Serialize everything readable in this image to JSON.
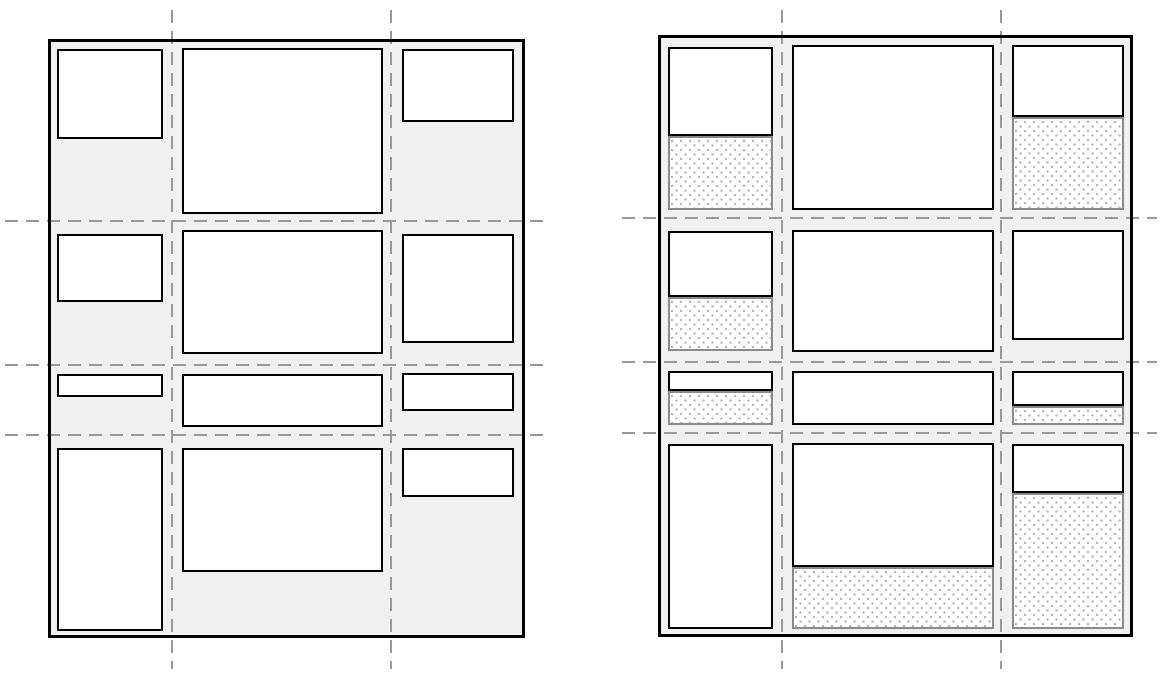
{
  "colors": {
    "page_background": "#ffffff",
    "container_fill": "#f0f0f0",
    "container_border": "#000000",
    "item_fill": "#ffffff",
    "item_border": "#000000",
    "gridline": "#999999",
    "placeholder_border": "#8a8a8a",
    "placeholder_fill": "#ffffff",
    "placeholder_dot": "#b4b4b4"
  },
  "gridline_style": {
    "dash_length": 13,
    "gap_length": 8,
    "thickness": 2.6
  },
  "panels": [
    {
      "name": "left-grid",
      "container": {
        "x": 48,
        "y": 39,
        "w": 477,
        "h": 599
      },
      "v_gridlines": [
        {
          "x": 172,
          "y1": 10,
          "y2": 669
        },
        {
          "x": 391,
          "y1": 10,
          "y2": 669
        }
      ],
      "h_gridlines": [
        {
          "y": 221,
          "x1": 5,
          "x2": 545
        },
        {
          "y": 365,
          "x1": 5,
          "x2": 545
        },
        {
          "y": 435,
          "x1": 5,
          "x2": 545
        }
      ],
      "items": [
        {
          "row": 1,
          "col": 1,
          "x": 57,
          "y": 49,
          "w": 106,
          "h": 90
        },
        {
          "row": 1,
          "col": 2,
          "x": 182,
          "y": 48,
          "w": 201,
          "h": 166
        },
        {
          "row": 1,
          "col": 3,
          "x": 402,
          "y": 49,
          "w": 112,
          "h": 73
        },
        {
          "row": 2,
          "col": 1,
          "x": 57,
          "y": 234,
          "w": 106,
          "h": 68
        },
        {
          "row": 2,
          "col": 2,
          "x": 182,
          "y": 230,
          "w": 201,
          "h": 124
        },
        {
          "row": 2,
          "col": 3,
          "x": 402,
          "y": 234,
          "w": 112,
          "h": 109
        },
        {
          "row": 3,
          "col": 1,
          "x": 57,
          "y": 374,
          "w": 106,
          "h": 23
        },
        {
          "row": 3,
          "col": 2,
          "x": 182,
          "y": 374,
          "w": 201,
          "h": 53
        },
        {
          "row": 3,
          "col": 3,
          "x": 402,
          "y": 373,
          "w": 112,
          "h": 38
        },
        {
          "row": 4,
          "col": 1,
          "x": 57,
          "y": 448,
          "w": 106,
          "h": 183
        },
        {
          "row": 4,
          "col": 2,
          "x": 182,
          "y": 448,
          "w": 201,
          "h": 124
        },
        {
          "row": 4,
          "col": 3,
          "x": 402,
          "y": 448,
          "w": 112,
          "h": 49
        }
      ],
      "placeholders": []
    },
    {
      "name": "right-grid",
      "container": {
        "x": 658,
        "y": 35,
        "w": 475,
        "h": 602
      },
      "v_gridlines": [
        {
          "x": 782,
          "y1": 10,
          "y2": 669
        },
        {
          "x": 1001,
          "y1": 10,
          "y2": 669
        }
      ],
      "h_gridlines": [
        {
          "y": 218,
          "x1": 622,
          "x2": 1157
        },
        {
          "y": 362,
          "x1": 622,
          "x2": 1157
        },
        {
          "y": 433,
          "x1": 622,
          "x2": 1157
        }
      ],
      "items": [
        {
          "row": 1,
          "col": 1,
          "x": 668,
          "y": 47,
          "w": 105,
          "h": 89
        },
        {
          "row": 1,
          "col": 2,
          "x": 792,
          "y": 45,
          "w": 202,
          "h": 165
        },
        {
          "row": 1,
          "col": 3,
          "x": 1012,
          "y": 45,
          "w": 112,
          "h": 72
        },
        {
          "row": 2,
          "col": 1,
          "x": 668,
          "y": 231,
          "w": 105,
          "h": 66
        },
        {
          "row": 2,
          "col": 2,
          "x": 792,
          "y": 230,
          "w": 202,
          "h": 122
        },
        {
          "row": 2,
          "col": 3,
          "x": 1012,
          "y": 230,
          "w": 112,
          "h": 110
        },
        {
          "row": 3,
          "col": 1,
          "x": 668,
          "y": 371,
          "w": 105,
          "h": 20
        },
        {
          "row": 3,
          "col": 2,
          "x": 792,
          "y": 371,
          "w": 202,
          "h": 54
        },
        {
          "row": 3,
          "col": 3,
          "x": 1012,
          "y": 371,
          "w": 112,
          "h": 35
        },
        {
          "row": 4,
          "col": 1,
          "x": 668,
          "y": 444,
          "w": 105,
          "h": 185
        },
        {
          "row": 4,
          "col": 2,
          "x": 792,
          "y": 443,
          "w": 202,
          "h": 124
        },
        {
          "row": 4,
          "col": 3,
          "x": 1012,
          "y": 444,
          "w": 112,
          "h": 49
        }
      ],
      "placeholders": [
        {
          "row": 1,
          "col": 1,
          "x": 668,
          "y": 136,
          "w": 105,
          "h": 74
        },
        {
          "row": 1,
          "col": 3,
          "x": 1012,
          "y": 117,
          "w": 112,
          "h": 93
        },
        {
          "row": 2,
          "col": 1,
          "x": 668,
          "y": 297,
          "w": 105,
          "h": 54
        },
        {
          "row": 3,
          "col": 1,
          "x": 668,
          "y": 391,
          "w": 105,
          "h": 34
        },
        {
          "row": 3,
          "col": 3,
          "x": 1012,
          "y": 406,
          "w": 112,
          "h": 19
        },
        {
          "row": 4,
          "col": 2,
          "x": 792,
          "y": 567,
          "w": 202,
          "h": 62
        },
        {
          "row": 4,
          "col": 3,
          "x": 1012,
          "y": 493,
          "w": 112,
          "h": 136
        }
      ]
    }
  ]
}
